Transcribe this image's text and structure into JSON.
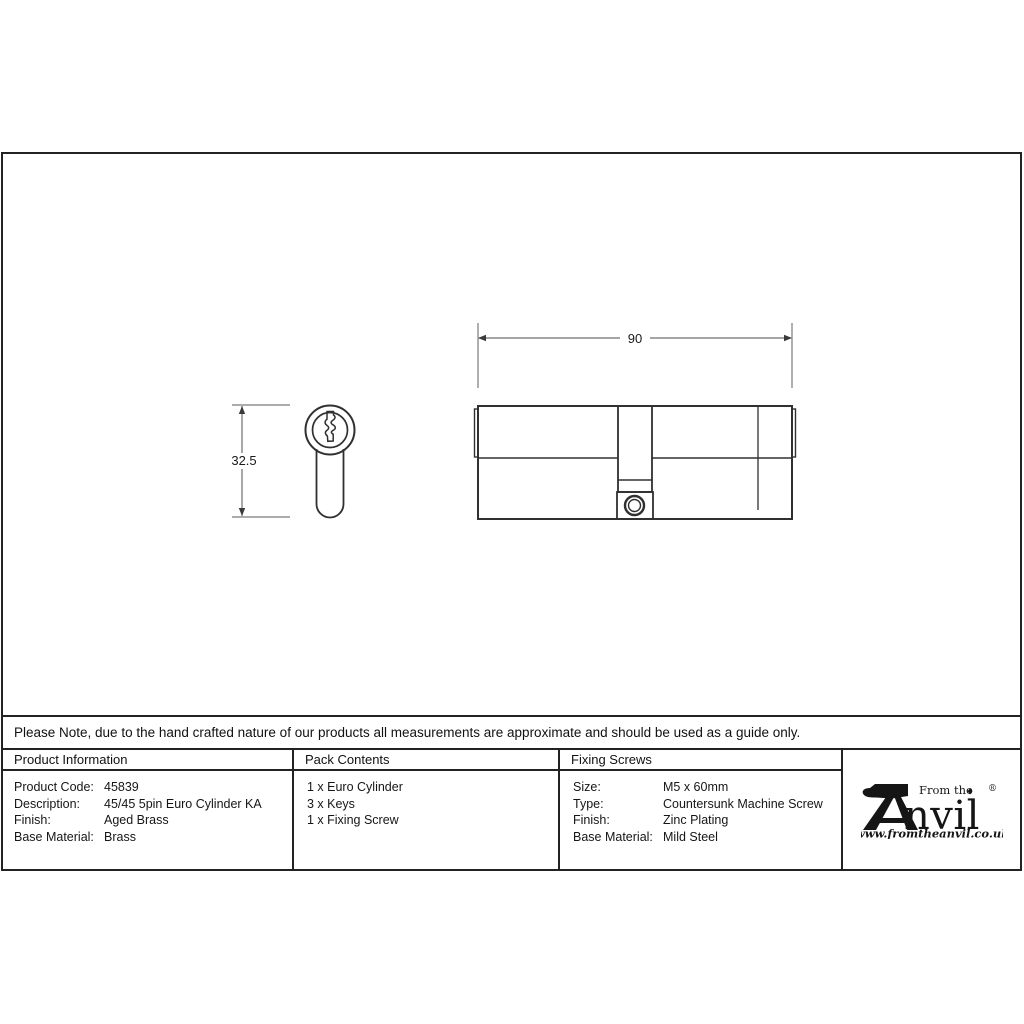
{
  "sheet": {
    "note": "Please Note, due to the hand crafted nature of our products all measurements are approximate and should be used as a guide only."
  },
  "drawing": {
    "length_dim": "90",
    "height_dim": "32.5"
  },
  "table": {
    "product_info": {
      "header": "Product Information",
      "rows": [
        {
          "label": "Product Code:",
          "value": "45839"
        },
        {
          "label": "Description:",
          "value": "45/45 5pin Euro Cylinder KA"
        },
        {
          "label": "Finish:",
          "value": "Aged Brass"
        },
        {
          "label": "Base Material:",
          "value": "Brass"
        }
      ]
    },
    "pack_contents": {
      "header": "Pack Contents",
      "items": [
        "1 x Euro Cylinder",
        "3 x Keys",
        "1 x Fixing Screw"
      ]
    },
    "fixing_screws": {
      "header": "Fixing Screws",
      "rows": [
        {
          "label": "Size:",
          "value": "M5 x 60mm"
        },
        {
          "label": "Type:",
          "value": "Countersunk Machine Screw"
        },
        {
          "label": "Finish:",
          "value": "Zinc Plating"
        },
        {
          "label": "Base Material:",
          "value": "Mild Steel"
        }
      ]
    }
  },
  "logo": {
    "brand_prefix": "From the",
    "brand_name_rest": "nvil",
    "registered_mark": "®",
    "diamond": "♦",
    "url": "www.fromtheanvil.co.uk"
  },
  "colors": {
    "object_line": "#303030",
    "dimension_line": "#6f6f6f",
    "border": "#222222",
    "background": "#ffffff"
  }
}
